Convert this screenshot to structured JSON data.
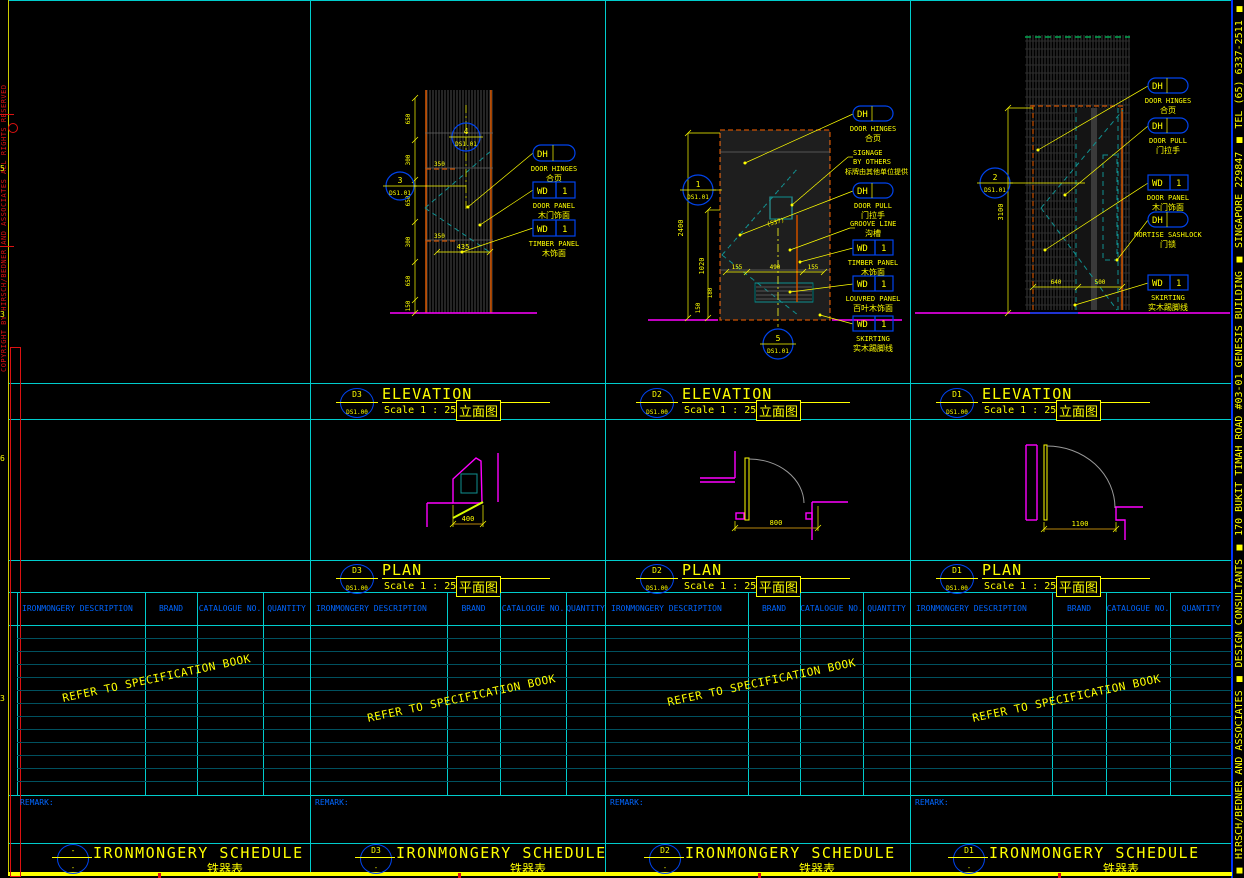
{
  "edge": {
    "copyright": "COPYRIGHT BY HIRSCH/BEDNER AND ASSOCIATES ALL RIGHTS RESERVED",
    "company": "■ HIRSCH/BEDNER AND ASSOCIATES  ■ DESIGN CONSULTANTS  ■ 170 BUKIT TIMAH ROAD #03-01 GENESIS BUILDING ■ SINGAPORE 229847 ■ TEL (65) 6337-2511 ■ FAX (65) 63",
    "ruler": [
      "5",
      "3",
      "6",
      "3"
    ]
  },
  "elevations": [
    {
      "id": "D3",
      "ref": "DS1.00",
      "title": "ELEVATION",
      "scale": "Scale 1 : 25",
      "title_cn": "立面图",
      "bubbles": [
        {
          "num": "3",
          "ref": "DS1.01"
        },
        {
          "num": "4",
          "ref": "DS1.01"
        }
      ],
      "callouts": [
        {
          "code": "DH",
          "qty": "",
          "label": "DOOR HINGES",
          "cn": "合页"
        },
        {
          "code": "WD",
          "qty": "1",
          "label": "DOOR PANEL",
          "cn": "木门饰面"
        },
        {
          "code": "WD",
          "qty": "1",
          "label": "TIMBER PANEL",
          "cn": "木饰面"
        }
      ],
      "dims": {
        "chain": [
          "650",
          "300",
          "650",
          "300",
          "650",
          "150"
        ],
        "inner_top": "350",
        "inner_bottom": "350",
        "width": "435"
      }
    },
    {
      "id": "D2",
      "ref": "DS1.00",
      "title": "ELEVATION",
      "scale": "Scale 1 : 25",
      "title_cn": "立面图",
      "bubbles": [
        {
          "num": "1",
          "ref": "DS1.01"
        },
        {
          "num": "5",
          "ref": "DS1.01"
        }
      ],
      "callouts": [
        {
          "code": "DH",
          "qty": "",
          "label": "DOOR HINGES",
          "cn": "合页"
        },
        {
          "code": "",
          "qty": "",
          "label": "SIGNAGE",
          "label2": "BY OTHERS",
          "cn": "标牌由其他单位提供"
        },
        {
          "code": "DH",
          "qty": "",
          "label": "DOOR PULL",
          "cn": "门拉手"
        },
        {
          "code": "",
          "qty": "",
          "label": "GROOVE LINE",
          "cn": "沟槽"
        },
        {
          "code": "WD",
          "qty": "1",
          "label": "TIMBER PANEL",
          "cn": "木饰面"
        },
        {
          "code": "WD",
          "qty": "1",
          "label": "LOUVRED PANEL",
          "cn": "百叶木饰面"
        },
        {
          "code": "WD",
          "qty": "1",
          "label": "SKIRTING",
          "cn": "实木踢脚线"
        }
      ],
      "dims": {
        "height": "2400",
        "inner_height": "1020",
        "small_a": "180",
        "small_b": "150",
        "signage": "(537)",
        "bottom": [
          "155",
          "490",
          "155"
        ]
      }
    },
    {
      "id": "D1",
      "ref": "DS1.00",
      "title": "ELEVATION",
      "scale": "Scale 1 : 25",
      "title_cn": "立面图",
      "bubbles": [
        {
          "num": "2",
          "ref": "DS1.01"
        }
      ],
      "callouts": [
        {
          "code": "DH",
          "qty": "",
          "label": "DOOR HINGES",
          "cn": "合页"
        },
        {
          "code": "DH",
          "qty": "",
          "label": "DOOR PULL",
          "cn": "门拉手"
        },
        {
          "code": "WD",
          "qty": "1",
          "label": "DOOR PANEL",
          "cn": "木门饰面"
        },
        {
          "code": "DH",
          "qty": "",
          "label": "MORTISE SASHLOCK",
          "cn": "门锁"
        },
        {
          "code": "WD",
          "qty": "1",
          "label": "SKIRTING",
          "cn": "实木踢脚线"
        }
      ],
      "dims": {
        "height": "3100",
        "bottom": [
          "640",
          "500"
        ]
      }
    }
  ],
  "plans": [
    {
      "id": "D3",
      "ref": "DS1.00",
      "title": "PLAN",
      "scale": "Scale 1 : 25",
      "title_cn": "平面图",
      "dim": "400"
    },
    {
      "id": "D2",
      "ref": "DS1.00",
      "title": "PLAN",
      "scale": "Scale 1 : 25",
      "title_cn": "平面图",
      "dim": "800"
    },
    {
      "id": "D1",
      "ref": "DS1.00",
      "title": "PLAN",
      "scale": "Scale 1 : 25",
      "title_cn": "平面图",
      "dim": "1100"
    }
  ],
  "schedule": {
    "headers": [
      "IRONMONGERY DESCRIPTION",
      "BRAND",
      "CATALOGUE NO.",
      "QUANTITY"
    ],
    "watermark": "REFER TO SPECIFICATION BOOK",
    "remark": "REMARK:",
    "title": "IRONMONGERY SCHEDULE",
    "title_cn": "铁器表",
    "sections": [
      {
        "num": "-",
        "ref": "-"
      },
      {
        "num": "D3",
        "ref": "-"
      },
      {
        "num": "D2",
        "ref": "-"
      },
      {
        "num": "D1",
        "ref": "-"
      }
    ]
  }
}
